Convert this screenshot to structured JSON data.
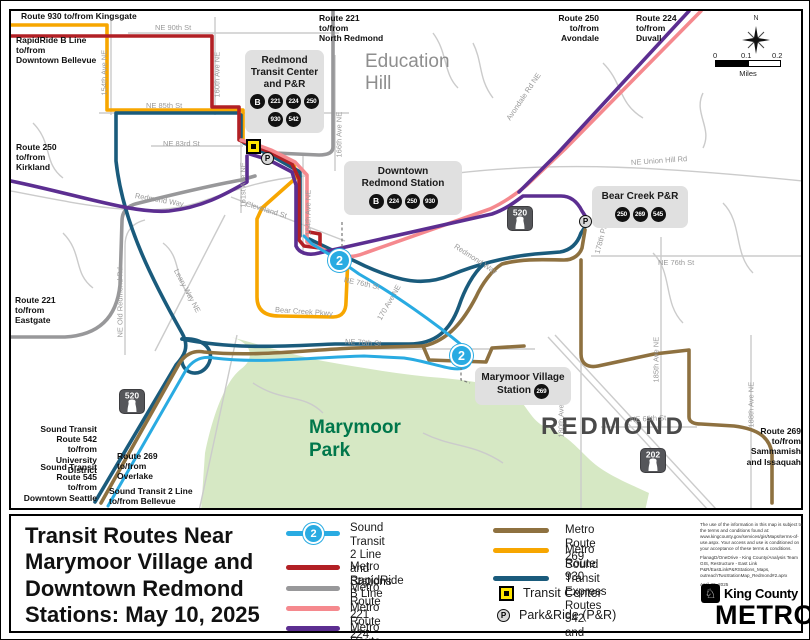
{
  "map": {
    "line2_badge": "2",
    "compass_n": "N",
    "scale": {
      "ticks": [
        "0",
        "0.1",
        "0.2"
      ],
      "unit": "Miles"
    },
    "edge_labels": [
      {
        "id": "route-930-kingsgate",
        "text": "Route 930 to/from Kingsgate",
        "x": 18,
        "y": 8
      },
      {
        "id": "rapidride-b-bellevue",
        "text": "RapidRide B Line\nto/from\nDowntown Bellevue",
        "x": 13,
        "y": 32
      },
      {
        "id": "route-250-kirkland",
        "text": "Route 250\nto/from\nKirkland",
        "x": 13,
        "y": 139
      },
      {
        "id": "route-221-eastgate",
        "text": "Route 221\nto/from\nEastgate",
        "x": 12,
        "y": 292
      },
      {
        "id": "st-542-university",
        "text": "Sound Transit\nRoute 542\nto/from\nUniversity District",
        "x": 26,
        "y": 421,
        "w": 68,
        "align": "right"
      },
      {
        "id": "st-545-seattle",
        "text": "Sound Transit\nRoute 545\nto/from\nDowntown Seattle",
        "x": 16,
        "y": 459,
        "w": 78,
        "align": "right"
      },
      {
        "id": "route-269-overlake",
        "text": "Route 269\nto/from\nOverlake",
        "x": 114,
        "y": 448
      },
      {
        "id": "st-2line-bellevue",
        "text": "Sound Transit 2 Line\nto/from Bellevue",
        "x": 106,
        "y": 483
      },
      {
        "id": "route-221-north-redmond",
        "text": "Route 221\nto/from\nNorth Redmond",
        "x": 316,
        "y": 10
      },
      {
        "id": "route-250-avondale",
        "text": "Route 250\nto/from\nAvondale",
        "x": 538,
        "y": 10,
        "w": 58,
        "align": "right"
      },
      {
        "id": "route-224-duvall",
        "text": "Route 224\nto/from\nDuvall",
        "x": 633,
        "y": 10
      },
      {
        "id": "route-269-sammamish",
        "text": "Route 269\nto/from\nSammamish\nand Issaquah",
        "x": 726,
        "y": 423,
        "w": 72,
        "align": "right"
      }
    ],
    "street_labels": [
      {
        "text": "NE 90th St",
        "x": 152,
        "y": 20,
        "r": 0
      },
      {
        "text": "NE 85th St",
        "x": 143,
        "y": 98,
        "r": 0
      },
      {
        "text": "NE 83rd St",
        "x": 160,
        "y": 136,
        "r": 0
      },
      {
        "text": "154th Ave NE",
        "x": 101,
        "y": 88,
        "r": -90
      },
      {
        "text": "160th Ave NE",
        "x": 214,
        "y": 90,
        "r": -90
      },
      {
        "text": "161st Ave NE",
        "x": 240,
        "y": 200,
        "r": -90
      },
      {
        "text": "166th Ave NE",
        "x": 336,
        "y": 150,
        "r": -90
      },
      {
        "text": "164th Ave NE",
        "x": 305,
        "y": 228,
        "r": -90
      },
      {
        "text": "Redmond Way",
        "x": 132,
        "y": 188,
        "r": 10
      },
      {
        "text": "Redmond Way",
        "x": 452,
        "y": 238,
        "r": 33
      },
      {
        "text": "Cleveland St",
        "x": 243,
        "y": 196,
        "r": 17
      },
      {
        "text": "Leary Way NE",
        "x": 173,
        "y": 262,
        "r": 62
      },
      {
        "text": "NE Old Redmond Rd",
        "x": 117,
        "y": 330,
        "r": -90
      },
      {
        "text": "Bear Creek Pkwy",
        "x": 272,
        "y": 302,
        "r": 4
      },
      {
        "text": "NE 76th St",
        "x": 341,
        "y": 272,
        "r": 12
      },
      {
        "text": "NE 76th St",
        "x": 655,
        "y": 255,
        "r": 0
      },
      {
        "text": "170 Ave NE",
        "x": 376,
        "y": 312,
        "r": -60
      },
      {
        "text": "178th Pl NE",
        "x": 594,
        "y": 246,
        "r": -75
      },
      {
        "text": "NE Union Hill Rd",
        "x": 628,
        "y": 155,
        "r": -4
      },
      {
        "text": "Avondale Rd NE",
        "x": 505,
        "y": 112,
        "r": -56
      },
      {
        "text": "180th Ave NE",
        "x": 558,
        "y": 430,
        "r": -90
      },
      {
        "text": "185th Ave NE",
        "x": 653,
        "y": 375,
        "r": -90
      },
      {
        "text": "188th Ave NE",
        "x": 748,
        "y": 420,
        "r": -90
      },
      {
        "text": "NE 70th St",
        "x": 342,
        "y": 334,
        "r": 3
      },
      {
        "text": "NE 65th St",
        "x": 627,
        "y": 412,
        "r": -3
      }
    ],
    "area_labels": {
      "education_hill": {
        "text": "Education\nHill"
      },
      "marymoor_park": {
        "text": "Marymoor\nPark"
      },
      "redmond": {
        "text": "REDMOND"
      }
    },
    "shields": [
      {
        "num": "520",
        "x": 116,
        "y": 386
      },
      {
        "num": "520",
        "x": 504,
        "y": 203
      },
      {
        "num": "202",
        "x": 637,
        "y": 445
      }
    ],
    "stations": [
      {
        "id": "redmond-transit-center",
        "title": "Redmond\nTransit Center\nand P&R",
        "badges": [
          "B",
          "221",
          "224",
          "250",
          "930",
          "542"
        ],
        "x": 242,
        "y": 47,
        "w": 79
      },
      {
        "id": "downtown-redmond-station",
        "title": "Downtown\nRedmond Station",
        "badges": [
          "B",
          "224",
          "250",
          "930"
        ],
        "x": 341,
        "y": 158,
        "w": 118
      },
      {
        "id": "bear-creek-pr",
        "title": "Bear Creek P&R",
        "badges": [
          "250",
          "269",
          "545"
        ],
        "x": 589,
        "y": 183,
        "w": 96
      },
      {
        "id": "marymoor-village-station",
        "title": "Marymoor Village\nStation",
        "badges": [
          "269"
        ],
        "x": 472,
        "y": 364,
        "w": 96,
        "inline_badge": true
      }
    ],
    "line2_stations": [
      {
        "x": 325,
        "y": 246
      },
      {
        "x": 447,
        "y": 341
      }
    ],
    "tc_icons": [
      {
        "x": 243,
        "y": 136
      }
    ],
    "pr_icons": [
      {
        "x": 258,
        "y": 149
      },
      {
        "x": 576,
        "y": 212
      }
    ]
  },
  "legend": {
    "title": "Transit Routes Near\nMarymoor Village and\nDowntown Redmond\nStations: May 10, 2025",
    "col1": [
      {
        "id": "line2",
        "label": "Sound Transit 2 Line\nand Stations",
        "color": "#29abe2",
        "badge": "2"
      },
      {
        "id": "rapidride-b",
        "label": "Metro RapidRide B Line",
        "color": "#b22025"
      },
      {
        "id": "route-221",
        "label": "Metro Route 221",
        "color": "#98989a"
      },
      {
        "id": "route-224",
        "label": "Metro Route 224",
        "color": "#f5898e"
      },
      {
        "id": "route-250",
        "label": "Metro Route 250",
        "color": "#5c2e91"
      }
    ],
    "col2": [
      {
        "id": "route-269",
        "label": "Metro Route 269",
        "color": "#8e7140"
      },
      {
        "id": "route-930",
        "label": "Metro Route 930",
        "color": "#f7a600"
      },
      {
        "id": "st-express",
        "label": "Sound Transit Express\nRoutes 542 and 545",
        "color": "#1a5b7c",
        "two_line": true
      }
    ],
    "symbols": [
      {
        "id": "transit-center",
        "label": "Transit Center",
        "type": "tc"
      },
      {
        "id": "park-ride",
        "label": "Park&Ride (P&R)",
        "type": "pr"
      }
    ],
    "disclaimer": "The use of the information in this map is subject to the terms and conditions found at: www.kingcounty.gov/services/gis/Maps/terms-of-use.aspx. Your access and use is conditioned on your acceptance of these terms & conditions.",
    "credit": "FlanagD/OneDrive - King County/Analysis Team GIS, Restructure - East Link P&R/EastLinkP&RStations_Maps, outreachTwoStationMap_Redmond#2.aprx",
    "date": "April 30, 2025",
    "logo": {
      "county": "King County",
      "metro": "METRO"
    }
  }
}
